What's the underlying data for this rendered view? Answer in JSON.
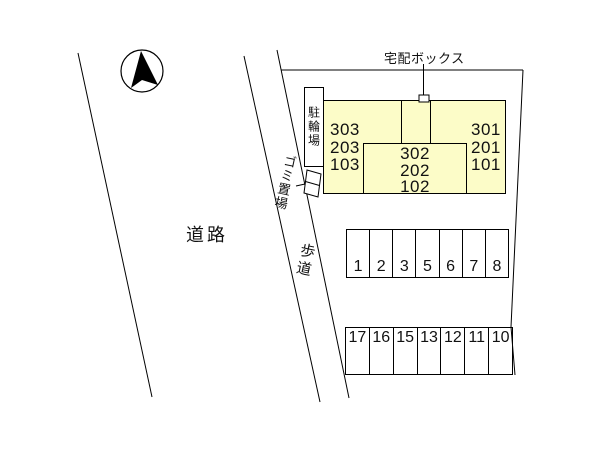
{
  "plan": {
    "title_labels": {
      "road": "道路",
      "sidewalk": "歩道",
      "garbage_area": "ゴミ置場",
      "bicycle_parking": "駐輪場",
      "delivery_box": "宅配ボックス"
    },
    "building": {
      "fill_color": "#FCFCC8",
      "left_units": [
        "303",
        "203",
        "103"
      ],
      "center_units": [
        "302",
        "202",
        "102"
      ],
      "right_units": [
        "301",
        "201",
        "101"
      ]
    },
    "parking": {
      "row1_stalls": [
        "1",
        "2",
        "3",
        "5",
        "6",
        "7",
        "8"
      ],
      "row2_stalls": [
        "17",
        "16",
        "15",
        "13",
        "12",
        "11",
        "10"
      ]
    }
  }
}
